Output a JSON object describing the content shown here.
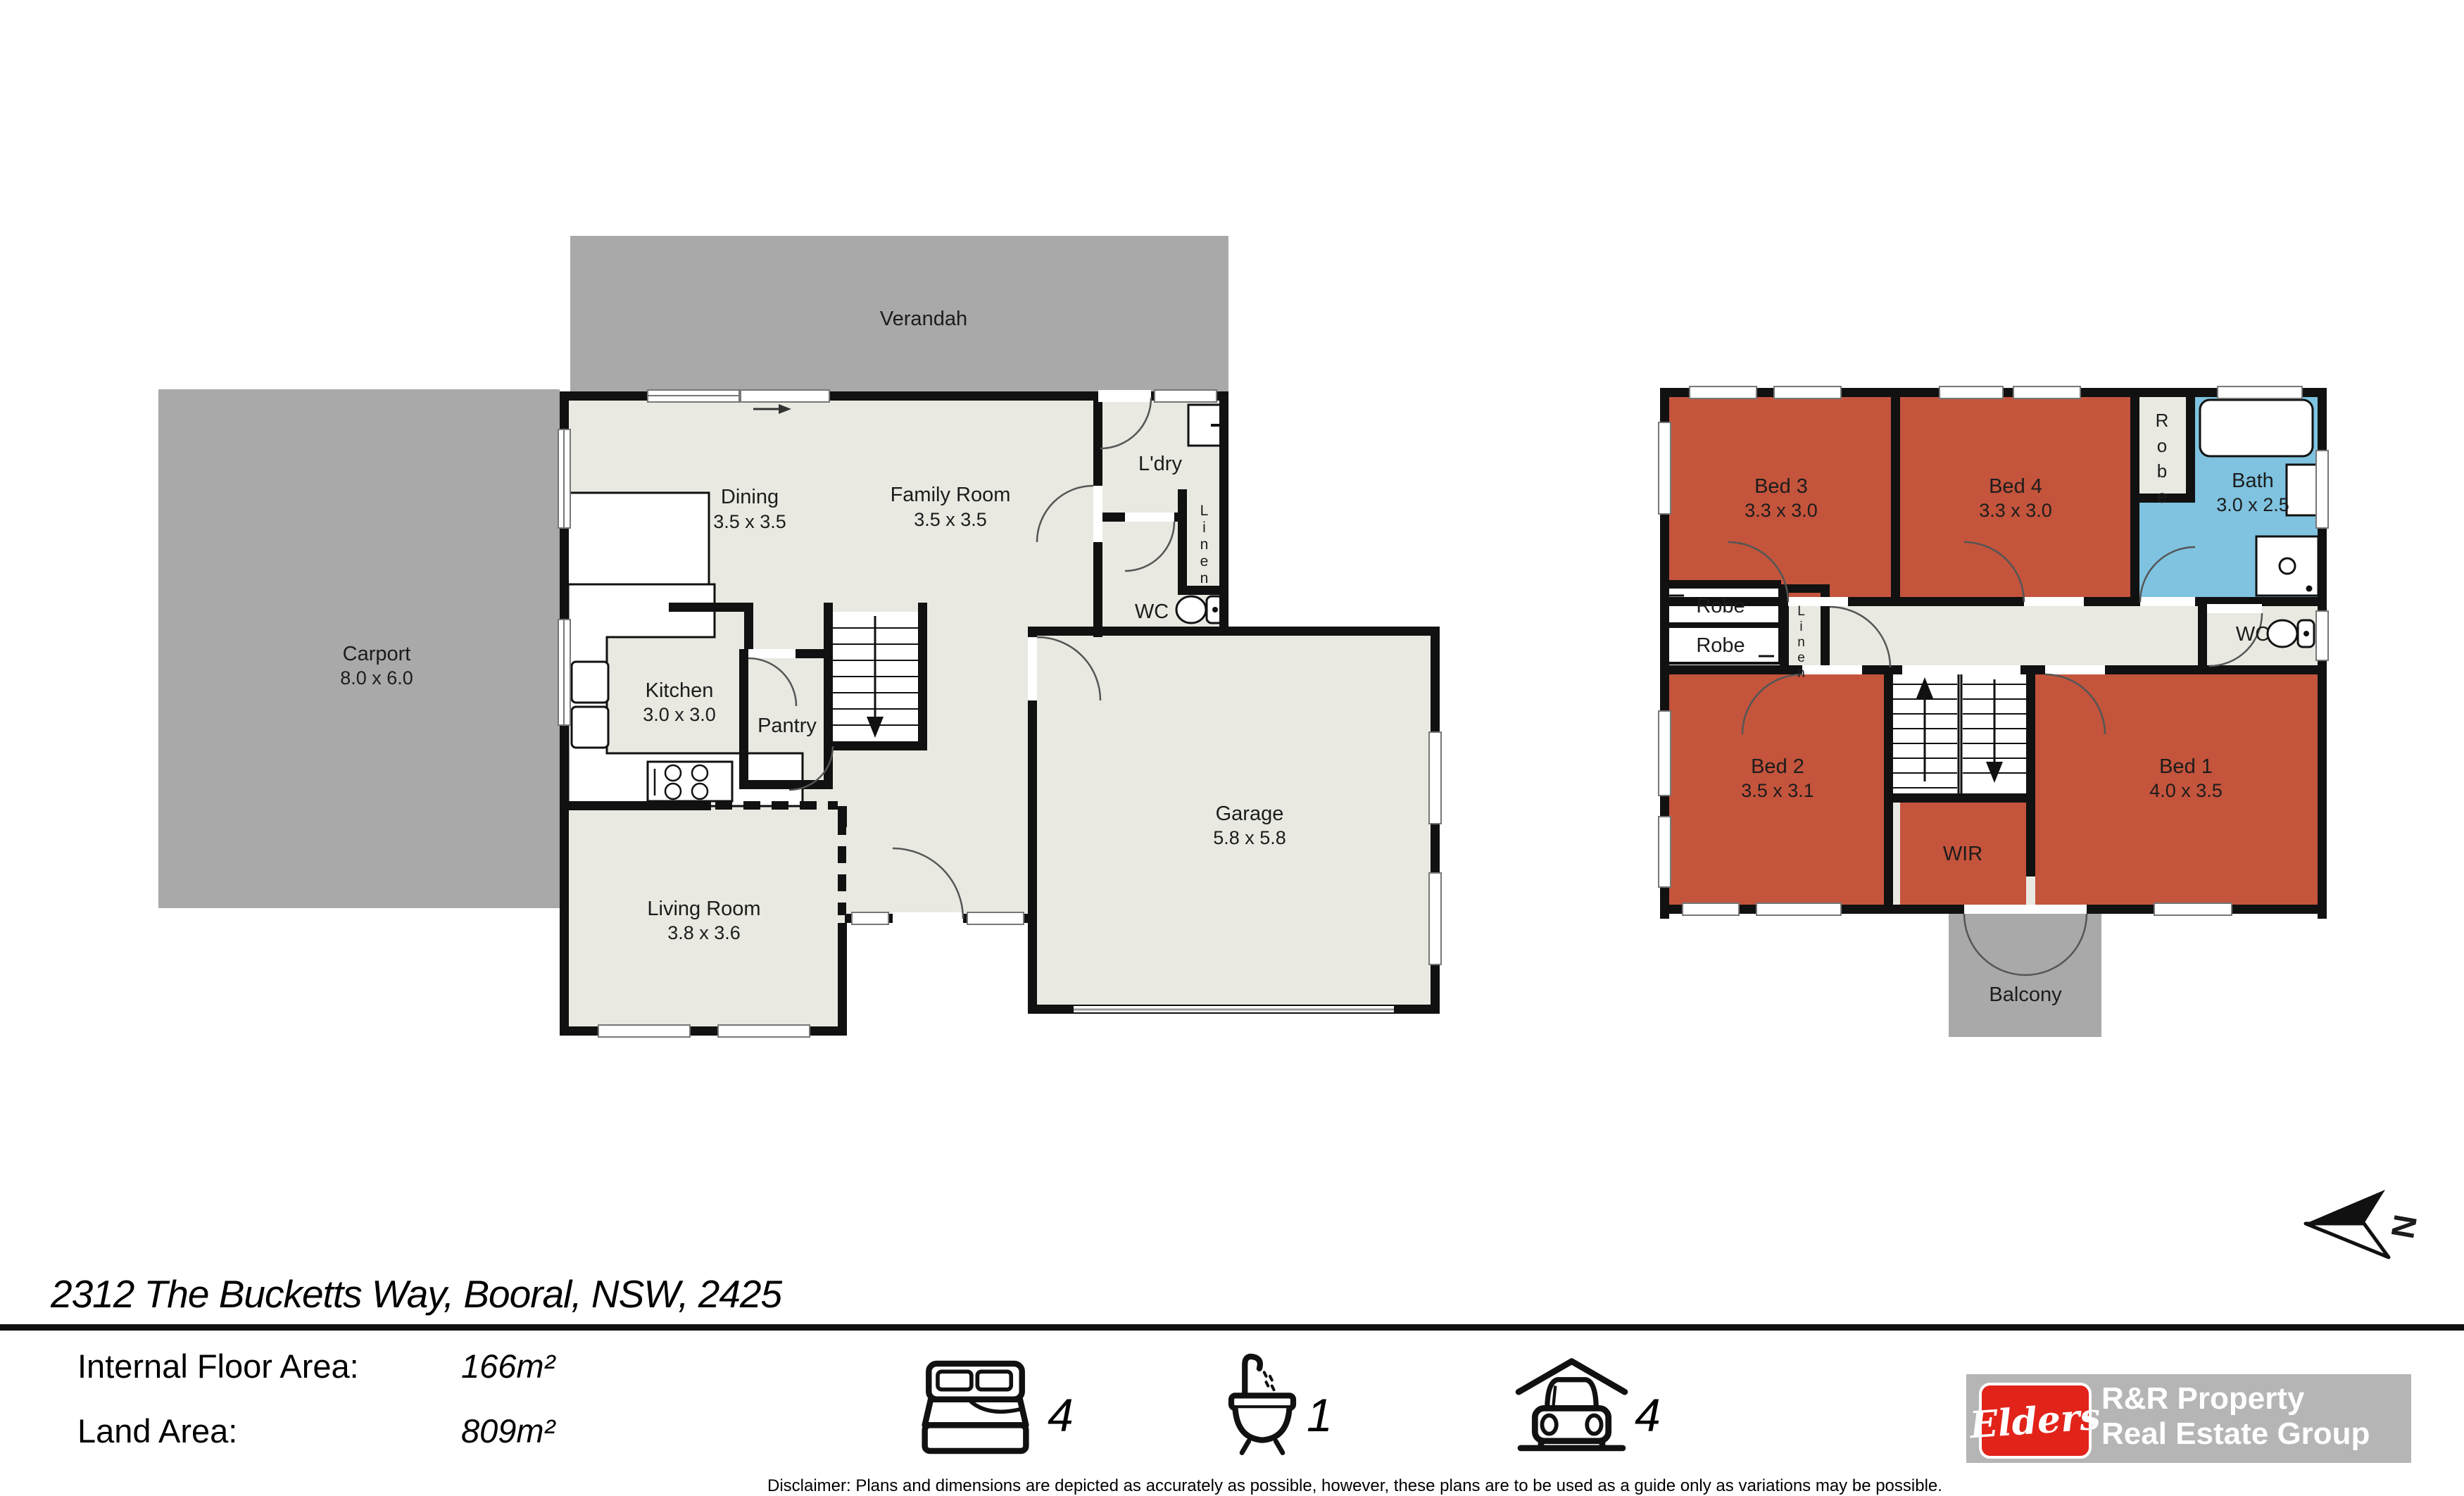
{
  "address_bar": {
    "address": "2312 The Bucketts Way, Booral, NSW, 2425"
  },
  "areas": {
    "internal_label": "Internal Floor Area:",
    "internal_value": "166m²",
    "land_label": "Land Area:",
    "land_value": "809m²"
  },
  "counts": {
    "beds": "4",
    "baths": "1",
    "cars": "4"
  },
  "branding": {
    "logo_script": "Elders",
    "agency_line1": "R&R Property",
    "agency_line2": "Real Estate Group",
    "logo_red": "#e2231a",
    "logo_gray": "#b5b5b5"
  },
  "compass": {
    "letter": "N"
  },
  "disclaimer": "Disclaimer: Plans and dimensions are depicted as accurately as possible, however, these plans are to be used as a guide only as variations may be possible.",
  "ground_floor": {
    "verandah": {
      "name": "Verandah"
    },
    "carport": {
      "name": "Carport",
      "dims": "8.0 x 6.0"
    },
    "dining": {
      "name": "Dining",
      "dims": "3.5 x 3.5"
    },
    "family": {
      "name": "Family Room",
      "dims": "3.5 x 3.5"
    },
    "kitchen": {
      "name": "Kitchen",
      "dims": "3.0 x 3.0"
    },
    "pantry": {
      "name": "Pantry"
    },
    "laundry": {
      "name": "L'dry"
    },
    "linen": {
      "name": "Linen"
    },
    "wc": {
      "name": "WC"
    },
    "living": {
      "name": "Living Room",
      "dims": "3.8 x 3.6"
    },
    "garage": {
      "name": "Garage",
      "dims": "5.8 x 5.8"
    }
  },
  "first_floor": {
    "bed3": {
      "name": "Bed 3",
      "dims": "3.3 x 3.0"
    },
    "bed4": {
      "name": "Bed 4",
      "dims": "3.3 x 3.0"
    },
    "robe_top": {
      "name": "Robe"
    },
    "bath": {
      "name": "Bath",
      "dims": "3.0 x 2.5"
    },
    "robe_a": {
      "name": "Robe"
    },
    "robe_b": {
      "name": "Robe"
    },
    "linen": {
      "name": "Linen"
    },
    "wc": {
      "name": "WC"
    },
    "bed2": {
      "name": "Bed 2",
      "dims": "3.5 x 3.1"
    },
    "bed1": {
      "name": "Bed 1",
      "dims": "4.0 x 3.5"
    },
    "wir": {
      "name": "WIR"
    },
    "balcony": {
      "name": "Balcony"
    }
  },
  "colors": {
    "outdoor_gray": "#a9a9a9",
    "floor_cream": "#e9e9e2",
    "bedroom_red": "#c4543c",
    "bath_blue": "#7fc3e0",
    "wall_black": "#111111"
  }
}
